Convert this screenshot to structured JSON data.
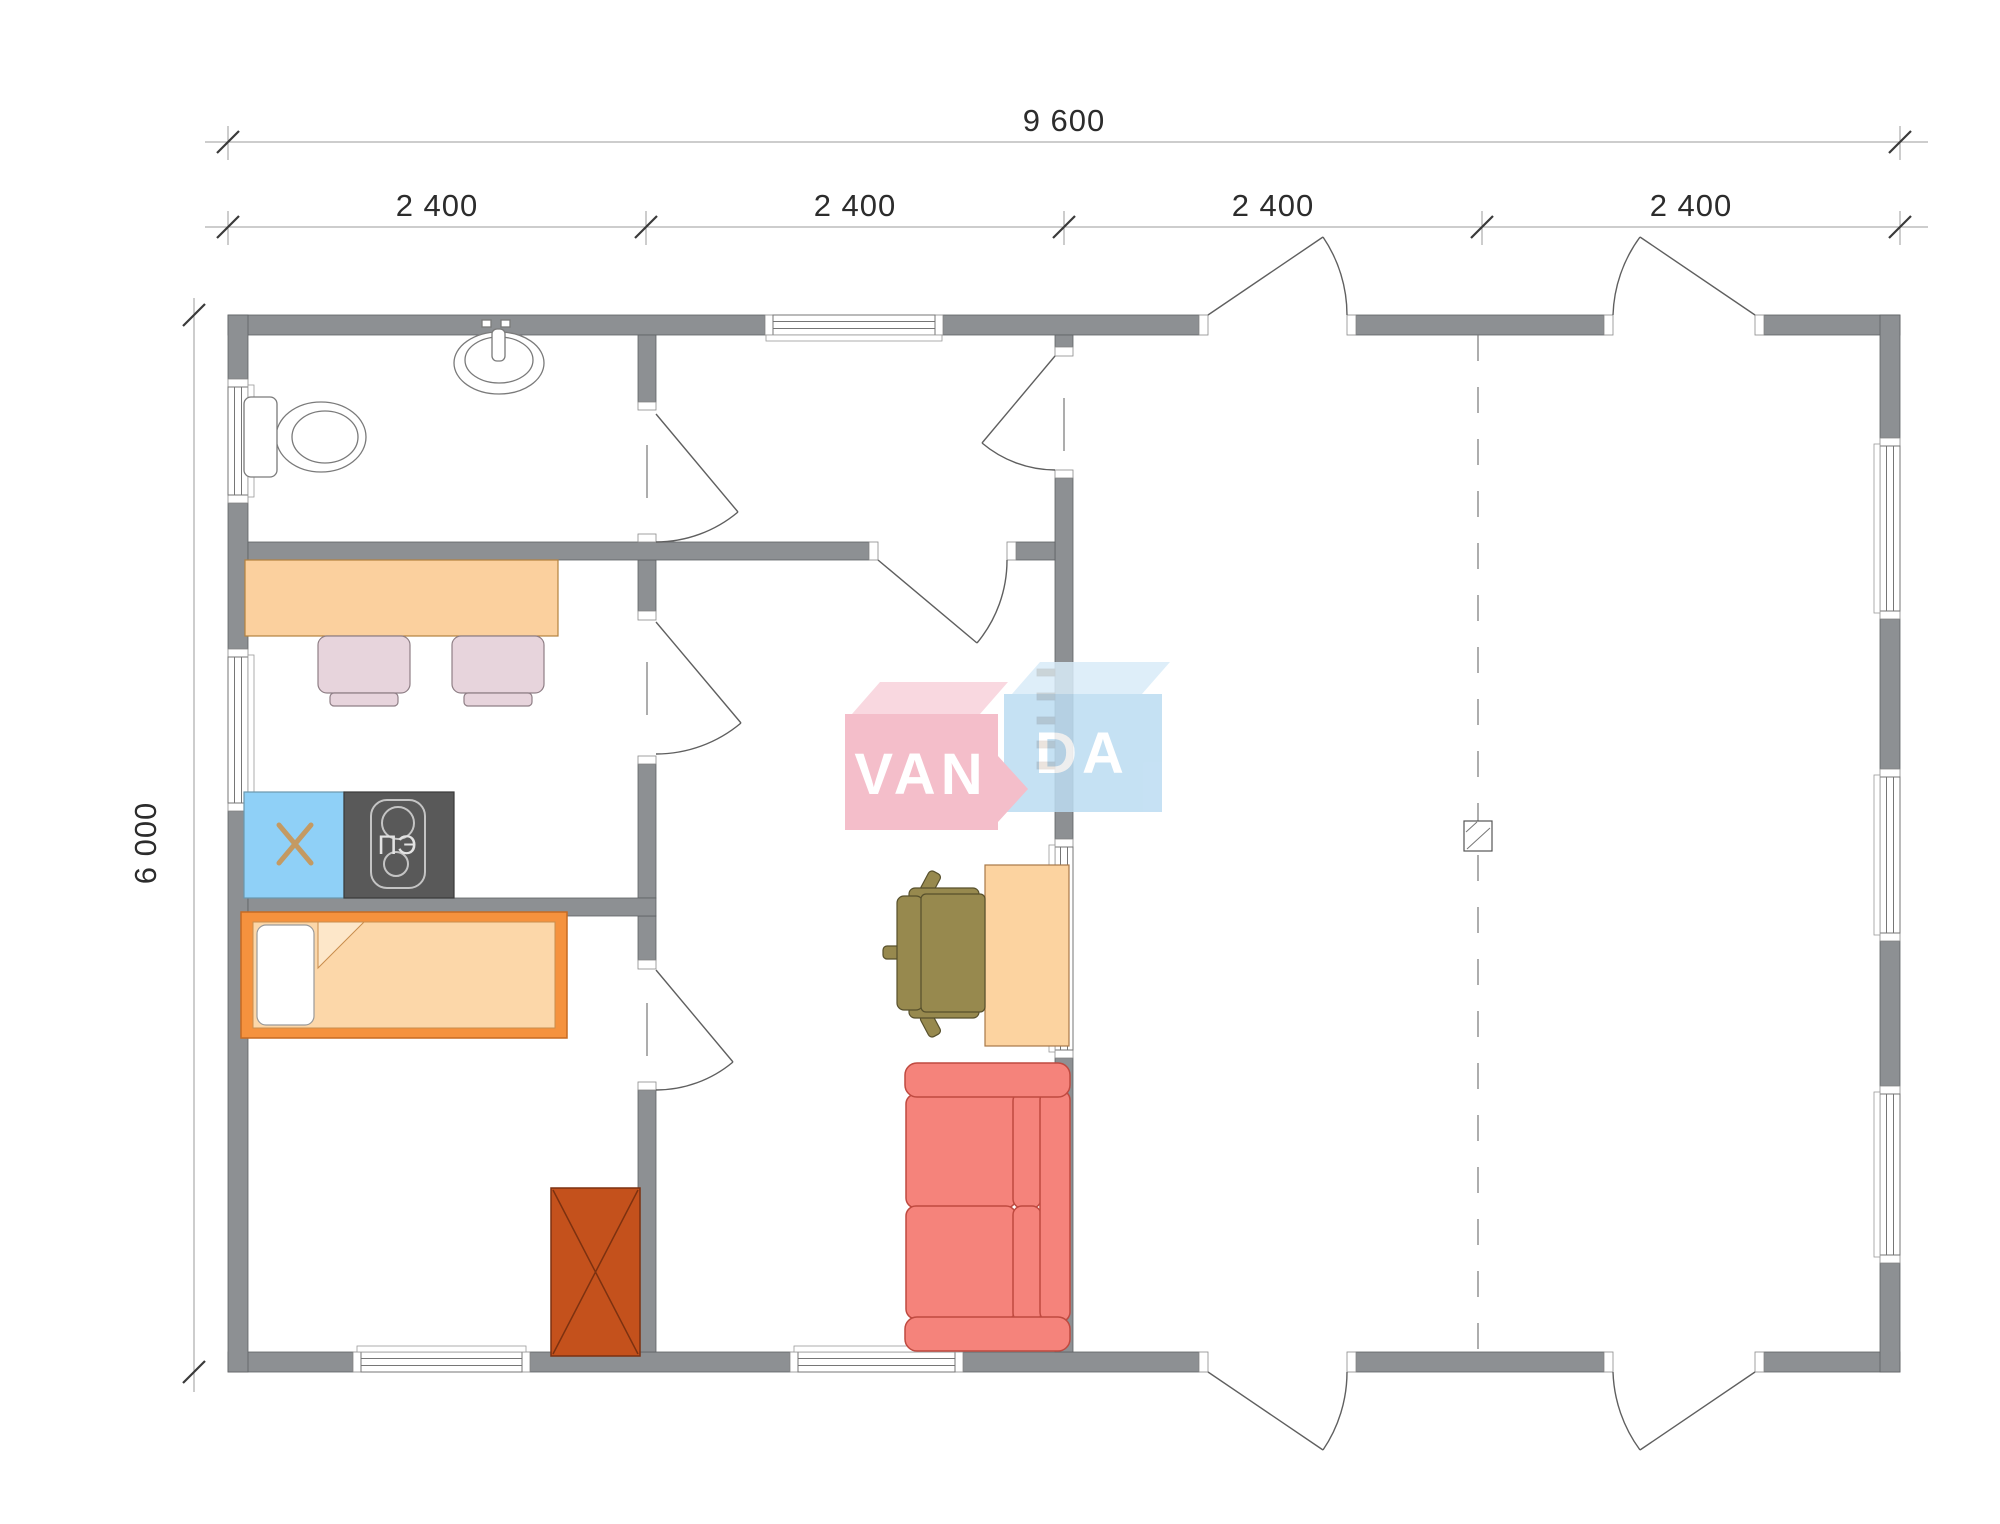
{
  "title": "Floor plan 9600 x 6000 with VANDA watermark",
  "dimensions": {
    "total": "9 600",
    "segments": [
      "2 400",
      "2 400",
      "2 400",
      "2 400"
    ],
    "height": "6 000"
  },
  "labels": {
    "stove": "ПЭ"
  },
  "logo": {
    "left": "VAN",
    "right": "DA",
    "full": "VANDA"
  },
  "fixtures": [
    "toilet",
    "sink",
    "kitchen-table",
    "dining-chair",
    "fridge",
    "electric-stove",
    "single-bed",
    "wardrobe",
    "desk",
    "office-chair",
    "sofa",
    "loft-ladder",
    "chimney"
  ],
  "colors": {
    "wall": "#8d9093",
    "dimText": "#2c2c2c",
    "table": "#fbd09e",
    "chair": "#e7d4dc",
    "fridge": "#8fd0f7",
    "fridgeCross": "#c49a62",
    "stove": "#595959",
    "stoveLabel": "#e3e3e3",
    "bedFrame": "#f5923e",
    "bedBlanket": "#fcd7a9",
    "bedFold": "#fde7c9",
    "pillow": "#ffffff",
    "wardrobe": "#c4511c",
    "desk": "#fcd3a0",
    "officeChair": "#97894e",
    "sofa": "#f5837b",
    "ladder": "#7a4b22",
    "logoPink": "#f3b3c1",
    "logoPinkTop": "#f8d2db",
    "logoBlue": "#bcdcf2",
    "logoBlueTop": "#d9ecf8",
    "logoText": "#ffffff"
  }
}
